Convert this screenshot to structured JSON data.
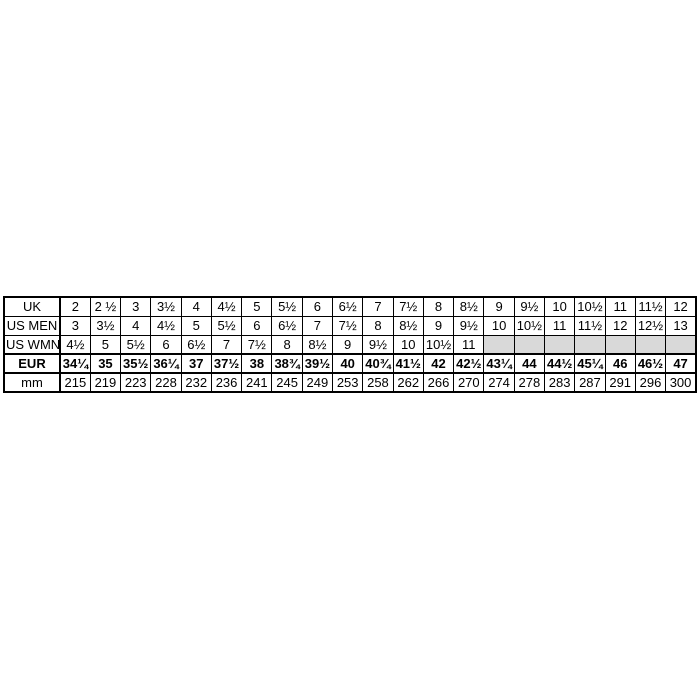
{
  "chart_data": {
    "type": "table",
    "description_title": "",
    "row_headers": [
      "UK",
      "US MEN",
      "US WMN",
      "EUR",
      "mm"
    ],
    "rows": [
      {
        "label": "UK",
        "bold": false,
        "emphasized": false,
        "values": [
          "2",
          "2 ½",
          "3",
          "3½",
          "4",
          "4½",
          "5",
          "5½",
          "6",
          "6½",
          "7",
          "7½",
          "8",
          "8½",
          "9",
          "9½",
          "10",
          "10½",
          "11",
          "11½",
          "12"
        ]
      },
      {
        "label": "US MEN",
        "bold": false,
        "emphasized": false,
        "values": [
          "3",
          "3½",
          "4",
          "4½",
          "5",
          "5½",
          "6",
          "6½",
          "7",
          "7½",
          "8",
          "8½",
          "9",
          "9½",
          "10",
          "10½",
          "11",
          "11½",
          "12",
          "12½",
          "13"
        ]
      },
      {
        "label": "US WMN",
        "bold": false,
        "emphasized": false,
        "values": [
          "4½",
          "5",
          "5½",
          "6",
          "6½",
          "7",
          "7½",
          "8",
          "8½",
          "9",
          "9½",
          "10",
          "10½",
          "11",
          "",
          "",
          "",
          "",
          "",
          "",
          ""
        ]
      },
      {
        "label": "EUR",
        "bold": true,
        "emphasized": true,
        "values": [
          "34¼",
          "35",
          "35½",
          "36¼",
          "37",
          "37½",
          "38",
          "38¾",
          "39½",
          "40",
          "40¾",
          "41½",
          "42",
          "42½",
          "43¼",
          "44",
          "44½",
          "45¼",
          "46",
          "46½",
          "47"
        ]
      },
      {
        "label": "mm",
        "bold": false,
        "emphasized": false,
        "values": [
          "215",
          "219",
          "223",
          "228",
          "232",
          "236",
          "241",
          "245",
          "249",
          "253",
          "258",
          "262",
          "266",
          "270",
          "274",
          "278",
          "283",
          "287",
          "291",
          "296",
          "300"
        ]
      }
    ]
  },
  "style": {
    "border_color": "#000000",
    "empty_cell_bg": "#d9d9d9",
    "background": "#ffffff",
    "label_col_width_px": 56
  }
}
